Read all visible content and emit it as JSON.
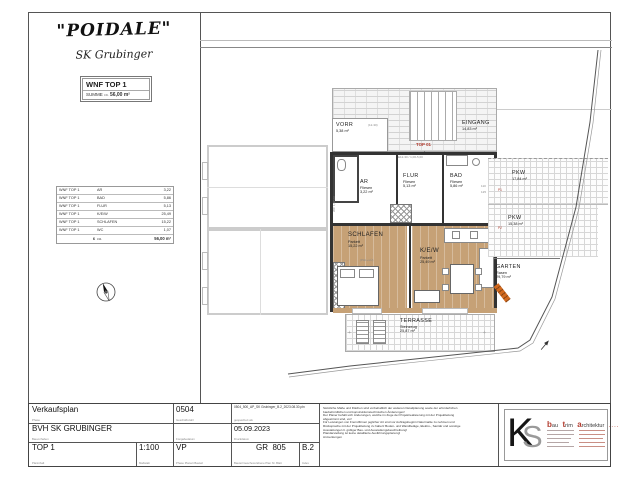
{
  "header": {
    "project_title": "\"POIDALE\"",
    "project_subtitle": "SK Grubinger",
    "unit_box": {
      "title": "WNF TOP 1",
      "summe_label": "SUMME",
      "ca_label": "ca.",
      "summe_value": "56,00 m²"
    }
  },
  "area_table": {
    "rows": [
      {
        "u": "WNF TOP 1",
        "r": "AR",
        "a": "3,22"
      },
      {
        "u": "WNF TOP 1",
        "r": "BAD",
        "a": "5,86"
      },
      {
        "u": "WNF TOP 1",
        "r": "FLUR",
        "a": "5,13"
      },
      {
        "u": "WNF TOP 1",
        "r": "K/E/W",
        "a": "25,49"
      },
      {
        "u": "WNF TOP 1",
        "r": "SCHLAFEN",
        "a": "15,22"
      },
      {
        "u": "WNF TOP 1",
        "r": "WC",
        "a": "1,07"
      }
    ],
    "total_count": "6",
    "total_ca": "ca.",
    "total_value": "56,00 m²"
  },
  "plan": {
    "eingang": {
      "name": "EINGANG",
      "area": "14,83 m²"
    },
    "vorr": {
      "name": "VORR",
      "area": "5,38 m²",
      "dim": "(12-30)"
    },
    "top_tag": "TOP 01",
    "wc": {
      "name": "WC",
      "area": "1,07 m²"
    },
    "ar": {
      "name": "AR",
      "finish": "Fliesen",
      "area": "3,22 m²"
    },
    "flur": {
      "name": "FLUR",
      "finish": "Fliesen",
      "area": "5,13 m²",
      "dim": "E12-30 / 1,00-5,00"
    },
    "bad": {
      "name": "BAD",
      "finish": "Fliesen",
      "area": "5,86 m²"
    },
    "schlafen": {
      "name": "SCHLAFEN",
      "finish": "Parkett",
      "area": "15,22 m²"
    },
    "kew": {
      "name": "K/E/W",
      "finish": "Parkett",
      "area": "25,49 m²"
    },
    "phl_note": "(PHL+LÜ)",
    "terrasse": {
      "name": "TERRASSE",
      "finish": "Steinzeug",
      "area": "25,87 m²"
    },
    "garten": {
      "name": "GARTEN",
      "finish": "Rasen",
      "area": "29,79 m²"
    },
    "pkw1": {
      "name": "PKW",
      "area": "17,84 m²",
      "tag": "P1"
    },
    "pkw2": {
      "name": "PKW",
      "area": "15,38 m²",
      "tag": "P2"
    },
    "pkw_dim_a": "110",
    "pkw_dim_b": "125",
    "plus_mark": "+"
  },
  "titleblock": {
    "verkaufsplan": {
      "value": "Verkaufsplan",
      "label": "Phase"
    },
    "bauvorhaben": {
      "value": "BVH SK GRUBINGER",
      "label": "Bauvorhaben"
    },
    "planinhalt": {
      "value": "TOP 1",
      "label": "Planinhalt"
    },
    "massstab": {
      "value": "1:100",
      "label": "Maßstab"
    },
    "vp": {
      "value": "VP",
      "label": "Phase   Planart   Bauteil"
    },
    "gz": {
      "value": "0504",
      "label": "Geschäftszahl"
    },
    "freigabe": {
      "label": "Freigabedatum"
    },
    "file": {
      "value": "0504_500_AP_SK Grubinger_B.2_2023.08.30.pln",
      "label": "gespeichert als"
    },
    "druckdatum": {
      "value": "05.09.2023",
      "label": "Druckdatum"
    },
    "ebene": {
      "value": "GR",
      "plannr": "805",
      "label": "Bauteil   Geschoss   Ebene   Plan Nr.  Blatt"
    },
    "index": {
      "value": "B.2",
      "label": "Index"
    },
    "disclaimer": [
      "Sämtliche Maße und Flächen sind vorbehaltlich der weiteren Detailplanung sowie der erforderlichen",
      "baubehördlichen und konstruktionstechnischen Änderungen!",
      "Der Planer behält sich Änderungen, welche im Zuge der Projektrealisierung mit der Projektleitung",
      "abgestimmt sind, vor!",
      "Für Leistungen von Fremdfirmen jeglicher Art sind vor Auftragsbeginn Naturmaße zu nehmen und",
      "Rücksprache mit der Projektleitung zu halten! Boden- und Wandbeläge, Elektro-, Sanitär und sonstige",
      "Ausstattungen lt. gültiger Bau- und Ausstattungsbeschreibung!",
      "Plandarstellung ist keine detaillierte Ausführungsplanung!",
      "Anmerkungen"
    ]
  },
  "logo": {
    "mark_k": "K",
    "mark_s": "S",
    "w1_lead": "b",
    "w1_rest": "au",
    "w2_lead": "t",
    "w2_rest": "rim",
    "w3_lead": "a",
    "w3_rest": "rchitektur",
    "suffix": "...."
  },
  "colors": {
    "accent_red": "#b23b2e",
    "parquet_tan": "#c6a176",
    "gate_orange": "#d2691e"
  }
}
